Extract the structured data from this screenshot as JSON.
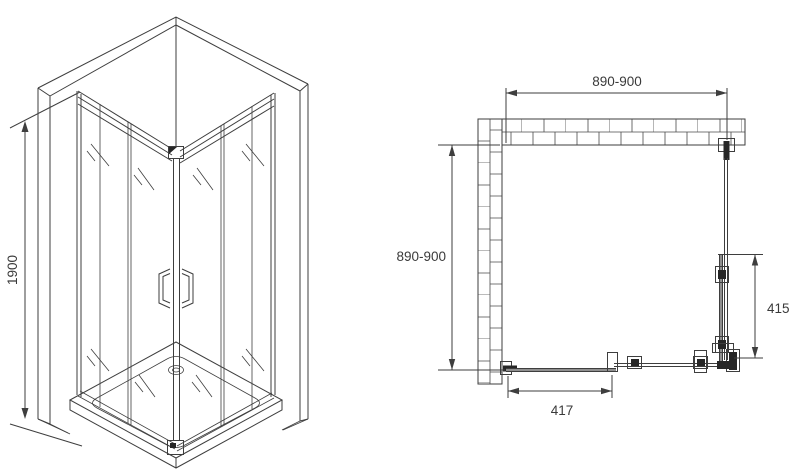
{
  "colors": {
    "line": "#3e3e3e",
    "dark_fill": "#262626",
    "text": "#3a3a3a",
    "background": "#ffffff"
  },
  "isometric_view": {
    "height_label": "1900"
  },
  "plan_view": {
    "top_width_label": "890-900",
    "left_depth_label": "890-900",
    "right_door_label": "415",
    "bottom_door_label": "417"
  }
}
